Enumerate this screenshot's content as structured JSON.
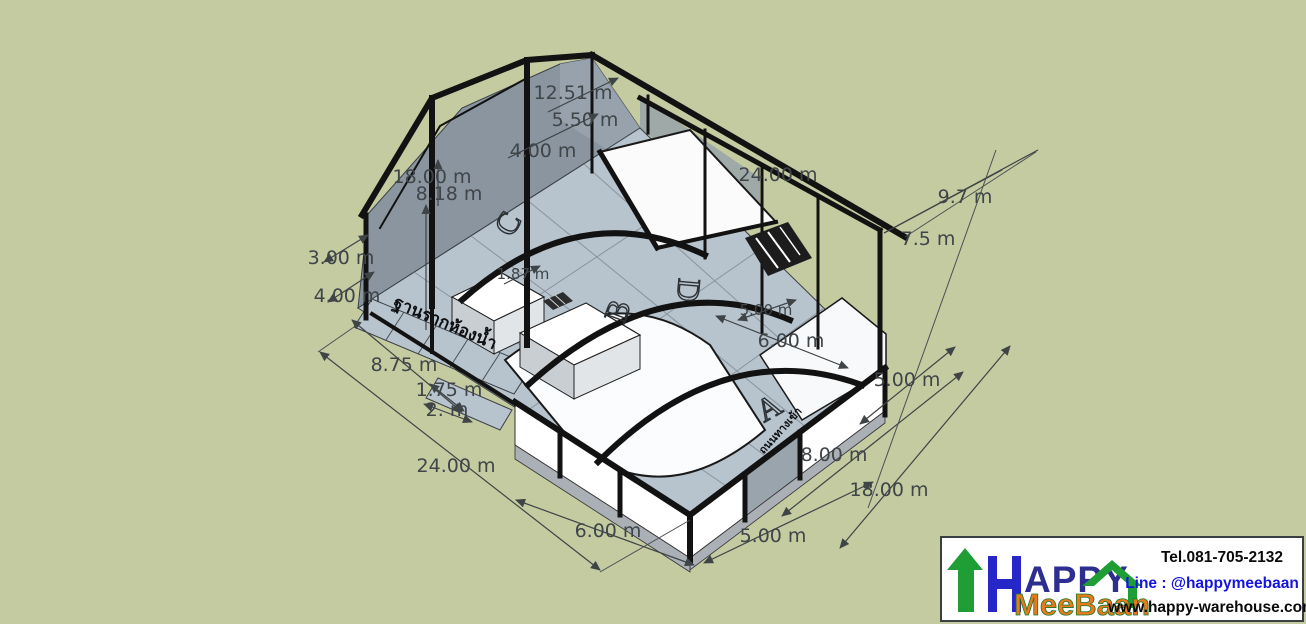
{
  "scene": {
    "description": "3D SketchUp-style warehouse model with dimension annotations",
    "background_color": "#c4cba0",
    "floor_color": "#b7c3cd",
    "wall_color": "#8a95a0",
    "frame_color": "#121212",
    "dimension_text_color": "#3f4549"
  },
  "dims": {
    "dim_1251": "12.51 m",
    "dim_550": "5.50 m",
    "dim_400_top": "4.00 m",
    "dim_1800_left": "18.00 m",
    "dim_818": "8.18 m",
    "dim_2400_top": "24.00 m",
    "dim_97": "9.7 m",
    "dim_75": "7.5 m",
    "dim_300": "3.00 m",
    "dim_400_left": "4.00 m",
    "dim_875": "8.75 m",
    "dim_175": "1.75 m",
    "dim_2": "2. m",
    "dim_2400_bottom": "24.00 m",
    "dim_600_bottom": "6.00 m",
    "dim_500_bottom": "5.00 m",
    "dim_800": "8.00 m",
    "dim_1800_right": "18.00 m",
    "dim_500_right": "5.00 m",
    "dim_600_inner": "6.00 m",
    "dim_500_inner": "5.00 m",
    "dim_187": "1.87 m"
  },
  "letters": {
    "a": "A",
    "b": "B",
    "c": "C",
    "d": "D"
  },
  "thai": {
    "slab_label": "ฐานรากห้องน้ำ",
    "entrance_label": "ถนนทางเข้า"
  },
  "logo": {
    "name_top": "APPY",
    "name_bottom": "MeeBaan",
    "tel": "Tel.081-705-2132",
    "line": "Line :  @happymeebaan",
    "web": "www.happy-warehouse.com",
    "green": "#1f9e35",
    "blue": "#2626c9",
    "orange": "#e8791c"
  }
}
